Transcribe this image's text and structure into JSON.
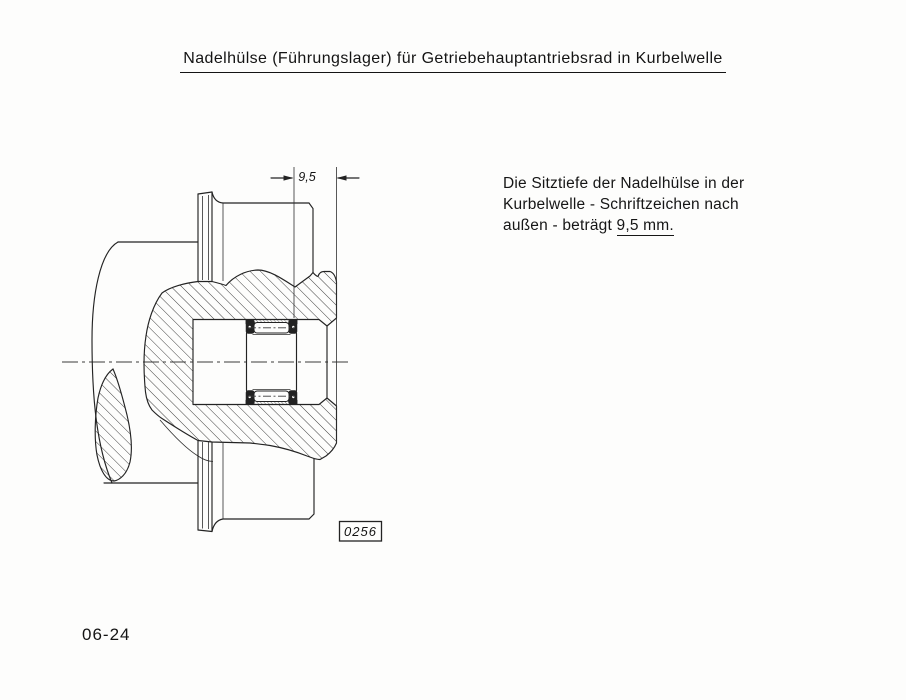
{
  "page": {
    "title": "Nadelhülse (Führungslager) für Getriebehauptantriebsrad in Kurbelwelle",
    "page_number": "06-24",
    "paper_color": "#fdfdfc",
    "ink_color": "#232323"
  },
  "note": {
    "line1": "Die Sitztiefe der Nadelhülse in der",
    "line2": "Kurbelwelle - Schriftzeichen nach",
    "line3_prefix": "außen - beträgt ",
    "line3_underlined": "9,5 mm."
  },
  "drawing": {
    "dimension_label": "9,5",
    "figure_number": "0256"
  }
}
